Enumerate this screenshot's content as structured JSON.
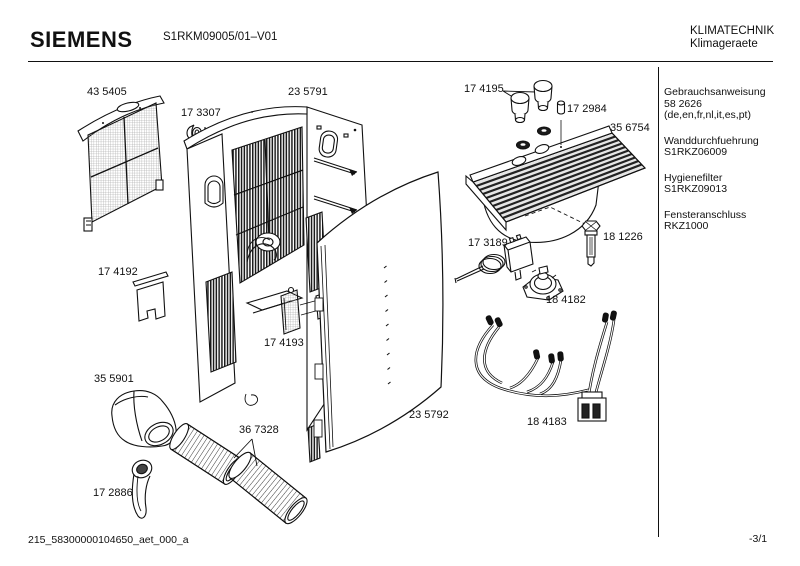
{
  "header": {
    "brand": "SIEMENS",
    "model": "S1RKM09005/01–V01",
    "division_line1": "KLIMATECHNIK",
    "division_line2": "Klimageraete"
  },
  "sidebar": {
    "entries": [
      {
        "lines": [
          "Gebrauchsanweisung",
          "58 2626",
          "(de,en,fr,nl,it,es,pt)"
        ]
      },
      {
        "lines": [
          "Wanddurchfuehrung",
          "S1RKZ06009"
        ]
      },
      {
        "lines": [
          "Hygienefilter",
          "S1RKZ09013"
        ]
      },
      {
        "lines": [
          "Fensteranschluss",
          "RKZ1000"
        ]
      }
    ]
  },
  "footer": {
    "doc_id": "215_58300000104650_aet_000_a",
    "page": "-3/1"
  },
  "diagram": {
    "part_labels": [
      {
        "id": "43 5405",
        "x": 87,
        "y": 86,
        "part": "intake-filter-grille"
      },
      {
        "id": "17 3307",
        "x": 181,
        "y": 107,
        "part": "small-knob"
      },
      {
        "id": "23 5791",
        "x": 288,
        "y": 86,
        "part": "housing-rear"
      },
      {
        "id": "17 4195",
        "x": 464,
        "y": 83,
        "part": "control-knobs"
      },
      {
        "id": "17 2984",
        "x": 567,
        "y": 103,
        "part": "push-button"
      },
      {
        "id": "35 6754",
        "x": 610,
        "y": 122,
        "part": "top-cover"
      },
      {
        "id": "17 3189",
        "x": 468,
        "y": 237,
        "part": "thermostat"
      },
      {
        "id": "18 1226",
        "x": 603,
        "y": 231,
        "part": "sensor"
      },
      {
        "id": "18 4182",
        "x": 546,
        "y": 294,
        "part": "rotary-switch"
      },
      {
        "id": "17 4192",
        "x": 98,
        "y": 266,
        "part": "flap"
      },
      {
        "id": "17 4193",
        "x": 264,
        "y": 337,
        "part": "filter-insert"
      },
      {
        "id": "35 5901",
        "x": 94,
        "y": 373,
        "part": "air-duct-elbow"
      },
      {
        "id": "23 5792",
        "x": 409,
        "y": 409,
        "part": "front-panel"
      },
      {
        "id": "36 7328",
        "x": 239,
        "y": 424,
        "part": "exhaust-hoses"
      },
      {
        "id": "18 4183",
        "x": 527,
        "y": 416,
        "part": "cable-harness"
      },
      {
        "id": "17 2886",
        "x": 93,
        "y": 487,
        "part": "strap"
      }
    ]
  }
}
